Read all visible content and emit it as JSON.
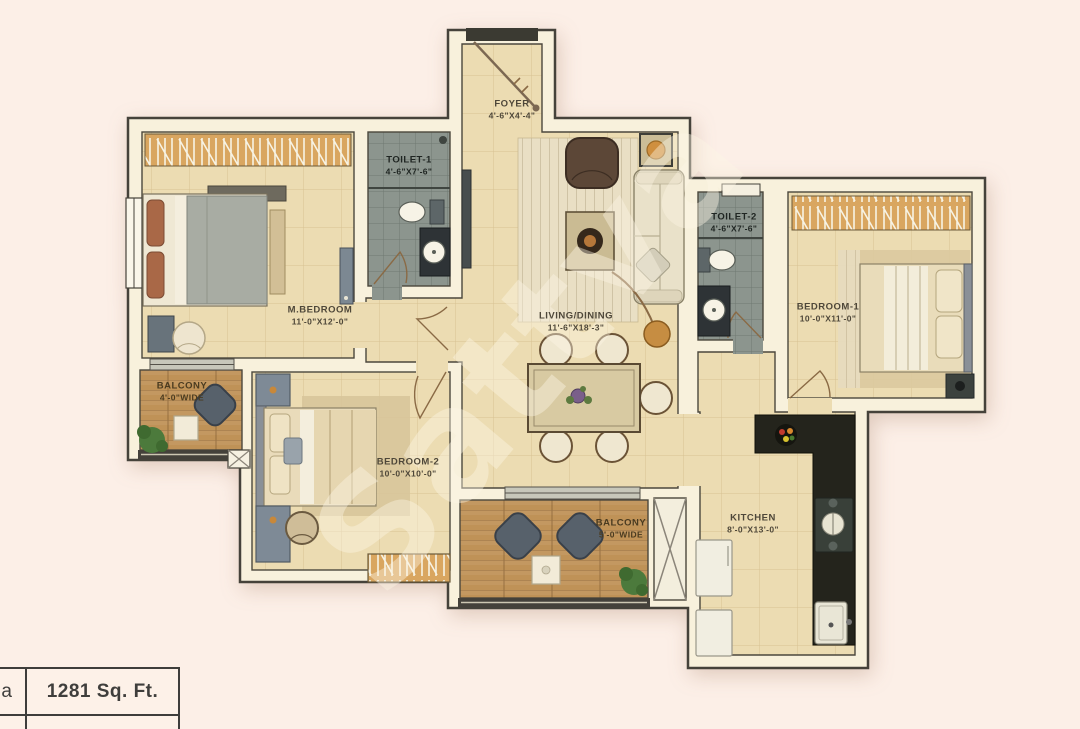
{
  "watermark": "Sattva",
  "area_table": {
    "partial_left_text": "a",
    "area_value": "1281 Sq. Ft."
  },
  "rooms": {
    "foyer": {
      "name": "FOYER",
      "dims": "4'-6\"X4'-4\""
    },
    "mbedroom": {
      "name": "M.BEDROOM",
      "dims": "11'-0\"X12'-0\""
    },
    "toilet1": {
      "name": "TOILET-1",
      "dims": "4'-6\"X7'-6\""
    },
    "living": {
      "name": "LIVING/DINING",
      "dims": "11'-6\"X18'-3\""
    },
    "toilet2": {
      "name": "TOILET-2",
      "dims": "4'-6\"X7'-6\""
    },
    "bedroom1": {
      "name": "BEDROOM-1",
      "dims": "10'-0\"X11'-0\""
    },
    "bedroom2": {
      "name": "BEDROOM-2",
      "dims": "10'-0\"X10'-0\""
    },
    "balcony1": {
      "name": "BALCONY",
      "dims": "4'-0\"WIDE"
    },
    "balcony2": {
      "name": "BALCONY",
      "dims": "5'-0\"WIDE"
    },
    "kitchen": {
      "name": "KITCHEN",
      "dims": "8'-0\"X13'-0\""
    }
  }
}
